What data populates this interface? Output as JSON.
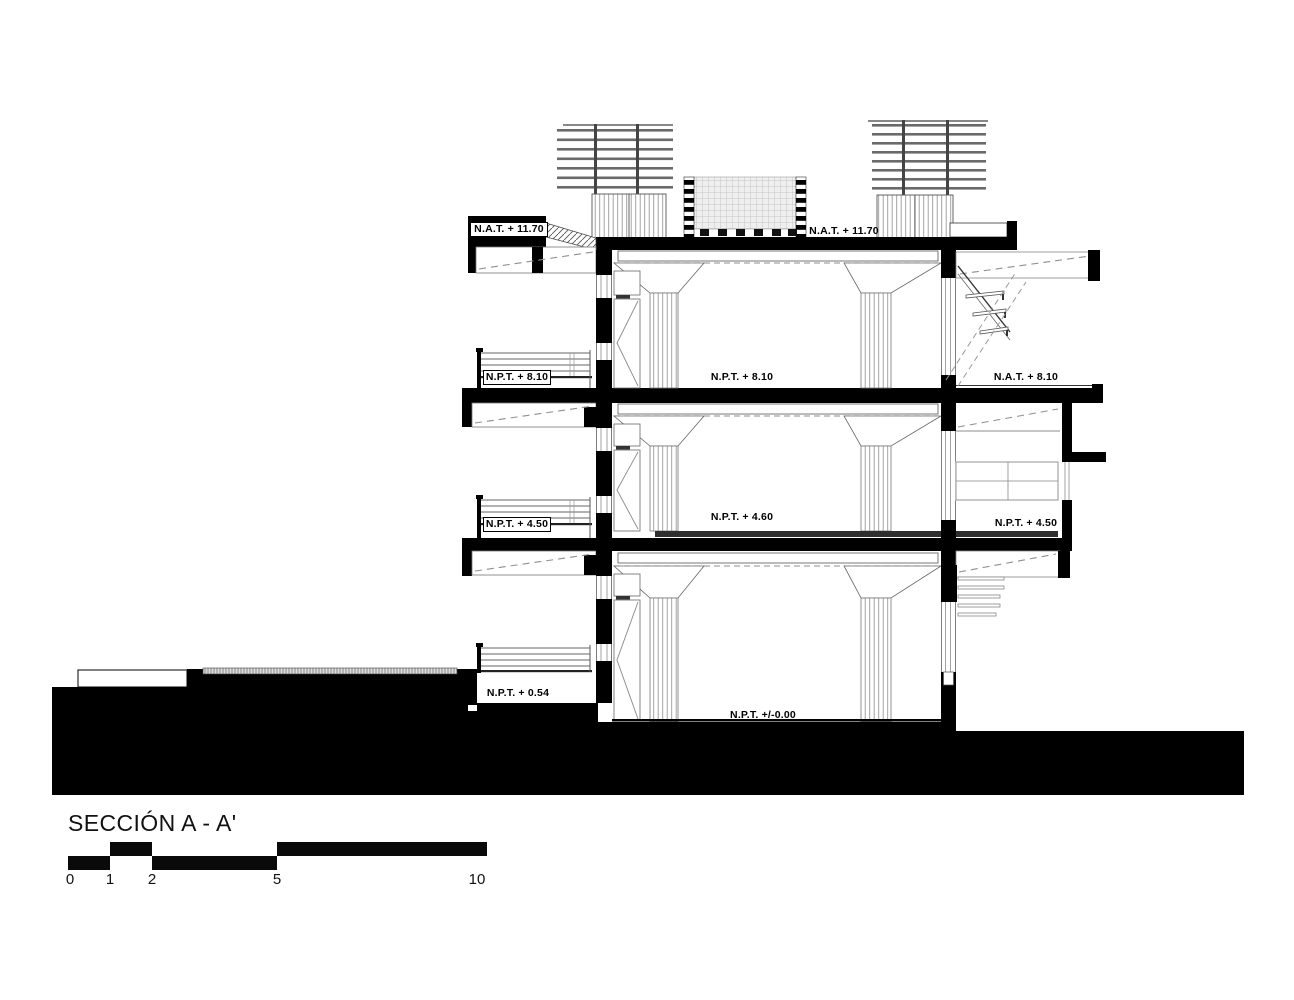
{
  "drawing": {
    "title": "SECCIÓN A - A'",
    "levels": {
      "nat_1170_left": "N.A.T. + 11.70",
      "nat_1170_right": "N.A.T. + 11.70",
      "npt_810_left": "N.P.T. + 8.10",
      "npt_810_center": "N.P.T. + 8.10",
      "nat_810_right": "N.A.T. + 8.10",
      "npt_450_left": "N.P.T. + 4.50",
      "npt_460_center": "N.P.T. + 4.60",
      "npt_450_right": "N.P.T. + 4.50",
      "npt_054": "N.P.T. + 0.54",
      "npt_000": "N.P.T. +/-0.00"
    },
    "scale_bar": {
      "marks": [
        "0",
        "1",
        "2",
        "5",
        "10"
      ]
    },
    "colors": {
      "ink": "#000000",
      "hatch_gray": "#8f8f8f",
      "mesh_gray": "#d9d9d9"
    }
  }
}
